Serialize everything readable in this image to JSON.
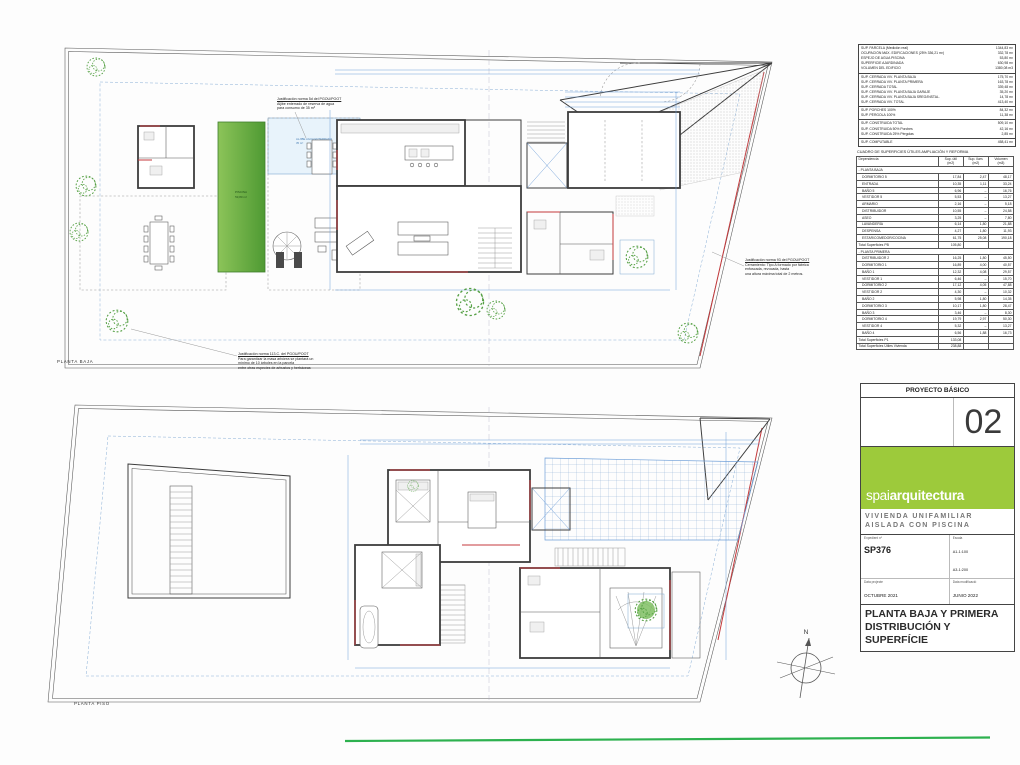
{
  "labels": {
    "planta_baja": "PLANTA BAJA",
    "planta_piso": "PLANTA PISO",
    "north": "N",
    "pool_line1": "PISCINA",
    "pool_line2": "53,80 m²",
    "aljibe_line1": "ALJIBE AGUA ENTERRADO",
    "aljibe_line2": "35 m³"
  },
  "notes": {
    "pool": {
      "title": "Justificación norma 5d del PGOU/POOT",
      "body": "Aljibe enterrado de reserva de agua\npara consumo de 35 m³"
    },
    "fence": {
      "title": "Justificación norma 93 del PGOU/POOT",
      "body": "Cerramiento: Tipo A formado por fábrica\nenfoscada, revocada, hasta\nuna altura máxima total de 2 metros."
    },
    "trees": {
      "title": "Justificación norma 113.C. del PGOU/POOT",
      "body": "Para garantizar la masa arbórea se plantará un\nmínimo de 10 árboles en la parcela\nentre otras especies de arbustos y herbáceas"
    }
  },
  "summary_table": {
    "groups": [
      [
        [
          "SUP. PARCELA (Medición real)",
          "1344,83 m²"
        ],
        [
          "OCUPACIÓN MÁX. EDIFICACIONES (25% 336,21 m²)",
          "332,78 m²"
        ],
        [
          "ESPEJO DE AGUA PISCINA",
          "53,80 m²"
        ],
        [
          "SUPERFICIE AJARDINADA",
          "630,98 m²"
        ],
        [
          "VOLUMEN DEL EDIFICIO",
          "1380,08 m3"
        ]
      ],
      [
        [
          "SUP. CERRADA VIV. PLANTA BAJA",
          "175,70 m²"
        ],
        [
          "SUP. CERRADA VIV. PLANTA PRIMERA",
          "163,78 m²"
        ],
        [
          "SUP. CERRADA TOTAL",
          "339,48 m²"
        ],
        [
          "SUP. CERRADA VIV. PLANTA BAJA GARAJE",
          "35,20 m²"
        ],
        [
          "SUP. CERRADA VIV. PLANTA BAJA SREG/INSTAL.",
          "14,78 m²"
        ],
        [
          "SUP. CERRADA VIV. TOTAL",
          "413,40 m²"
        ]
      ],
      [
        [
          "SUP. PORCHES 100%",
          "84,32 m²"
        ],
        [
          "SUP. PÉRGOLA 100%",
          "11,38 m²"
        ]
      ],
      [
        [
          "SUP. CONSTRUIDA TOTAL",
          "509,10 m²"
        ],
        [
          "SUP. CONSTRUIDA 50% Porches",
          "42,16 m²"
        ],
        [
          "SUP. CONSTRUIDA 25% Pérgolas",
          "2,85 m²"
        ]
      ],
      [
        [
          "SUP. COMPUTABLE",
          "458,41 m²"
        ]
      ]
    ]
  },
  "areas_table": {
    "title": "CUADRO DE SUPERFICIES ÚTILES AMPLIACIÓN Y REFORMA",
    "headers": [
      "Dependencia",
      "Sup. útil\n(m2)",
      "Sup. ilum.\n(m2)",
      "Volumen\n(m3)"
    ],
    "sections": [
      {
        "label": "- PLANTA BAJA",
        "rows": [
          [
            "DORMITORIO 5",
            "17,84",
            "2,47",
            "48,17"
          ],
          [
            "ENTRADA",
            "10,35",
            "1,11",
            "33,24"
          ],
          [
            "BAÑO 5",
            "6,96",
            "–",
            "16,76"
          ],
          [
            "VESTIDOR 5",
            "5,53",
            "–",
            "13,27"
          ],
          [
            "ARMARIO",
            "2,16",
            "–",
            "5,18"
          ],
          [
            "DISTRIBUIDOR",
            "10,55",
            "–",
            "24,58"
          ],
          [
            "ASEO",
            "3,25",
            "–",
            "7,80"
          ],
          [
            "LAVANDERÍA",
            "6,14",
            "1,80",
            "21,88"
          ],
          [
            "DESPENSA",
            "4,27",
            "1,80",
            "11,93"
          ],
          [
            "ESTAR/COMEDOR/COCINA",
            "61,75",
            "25,08",
            "190,18"
          ]
        ],
        "total": [
          "Total Superficies PB",
          "105,80"
        ]
      },
      {
        "label": "- PLANTA PRIMERA",
        "rows": [
          [
            "DISTRIBUIDOR 2",
            "16,25",
            "1,80",
            "45,50"
          ],
          [
            "DORMITORIO 1",
            "16,89",
            "4,00",
            "40,57"
          ],
          [
            "BAÑO 1",
            "12,32",
            "4,08",
            "29,57"
          ],
          [
            "VESTIDOR 1",
            "6,46",
            "–",
            "15,70"
          ],
          [
            "DORMITORIO 2",
            "17,12",
            "4,05",
            "47,88"
          ],
          [
            "VESTIDOR 2",
            "4,30",
            "–",
            "10,32"
          ],
          [
            "BAÑO 2",
            "5,98",
            "1,80",
            "14,35"
          ],
          [
            "DORMITORIO 3",
            "10,17",
            "1,80",
            "28,47"
          ],
          [
            "BAÑO 3",
            "3,46",
            "–",
            "8,30"
          ],
          [
            "DORMITORIO 4",
            "19,79",
            "2,97",
            "50,30"
          ],
          [
            "VESTIDOR 4",
            "5,32",
            "–",
            "13,27"
          ],
          [
            "BAÑO 4",
            "6,56",
            "1,88",
            "16,73"
          ]
        ],
        "total": [
          "Total Superficies P1",
          "133,08"
        ]
      }
    ],
    "grand_total": [
      "Total Superficies Útiles Vivienda",
      "238,88"
    ]
  },
  "title_block": {
    "header": "PROYECTO BÁSICO",
    "sheet_number": "02",
    "logo_light": "spai",
    "logo_bold": "arquitectura",
    "project_name": "VIVIENDA UNIFAMILIAR\nAISLADA CON PISCINA",
    "fields": {
      "expedient_label": "Expedient nº",
      "expedient_value": "SP376",
      "scale_label": "Escala",
      "scale_value": "A1-1:100\nA3-1:200",
      "date_label": "Data projecte",
      "date_value": "OCTUBRE 2021",
      "mod_label": "Data modificació",
      "mod_value": "JUNIO 2022"
    },
    "drawing_title": "PLANTA BAJA Y PRIMERA\nDISTRIBUCIÓN Y SUPERFÍCIE"
  },
  "colors": {
    "accent_green": "#9dca3b",
    "pool_green": "#5aa83a",
    "line_blue": "#6f9fd8",
    "wall_dark": "#3d3d3d",
    "accent_red": "#c4393c",
    "footer_green": "#2db14f"
  }
}
